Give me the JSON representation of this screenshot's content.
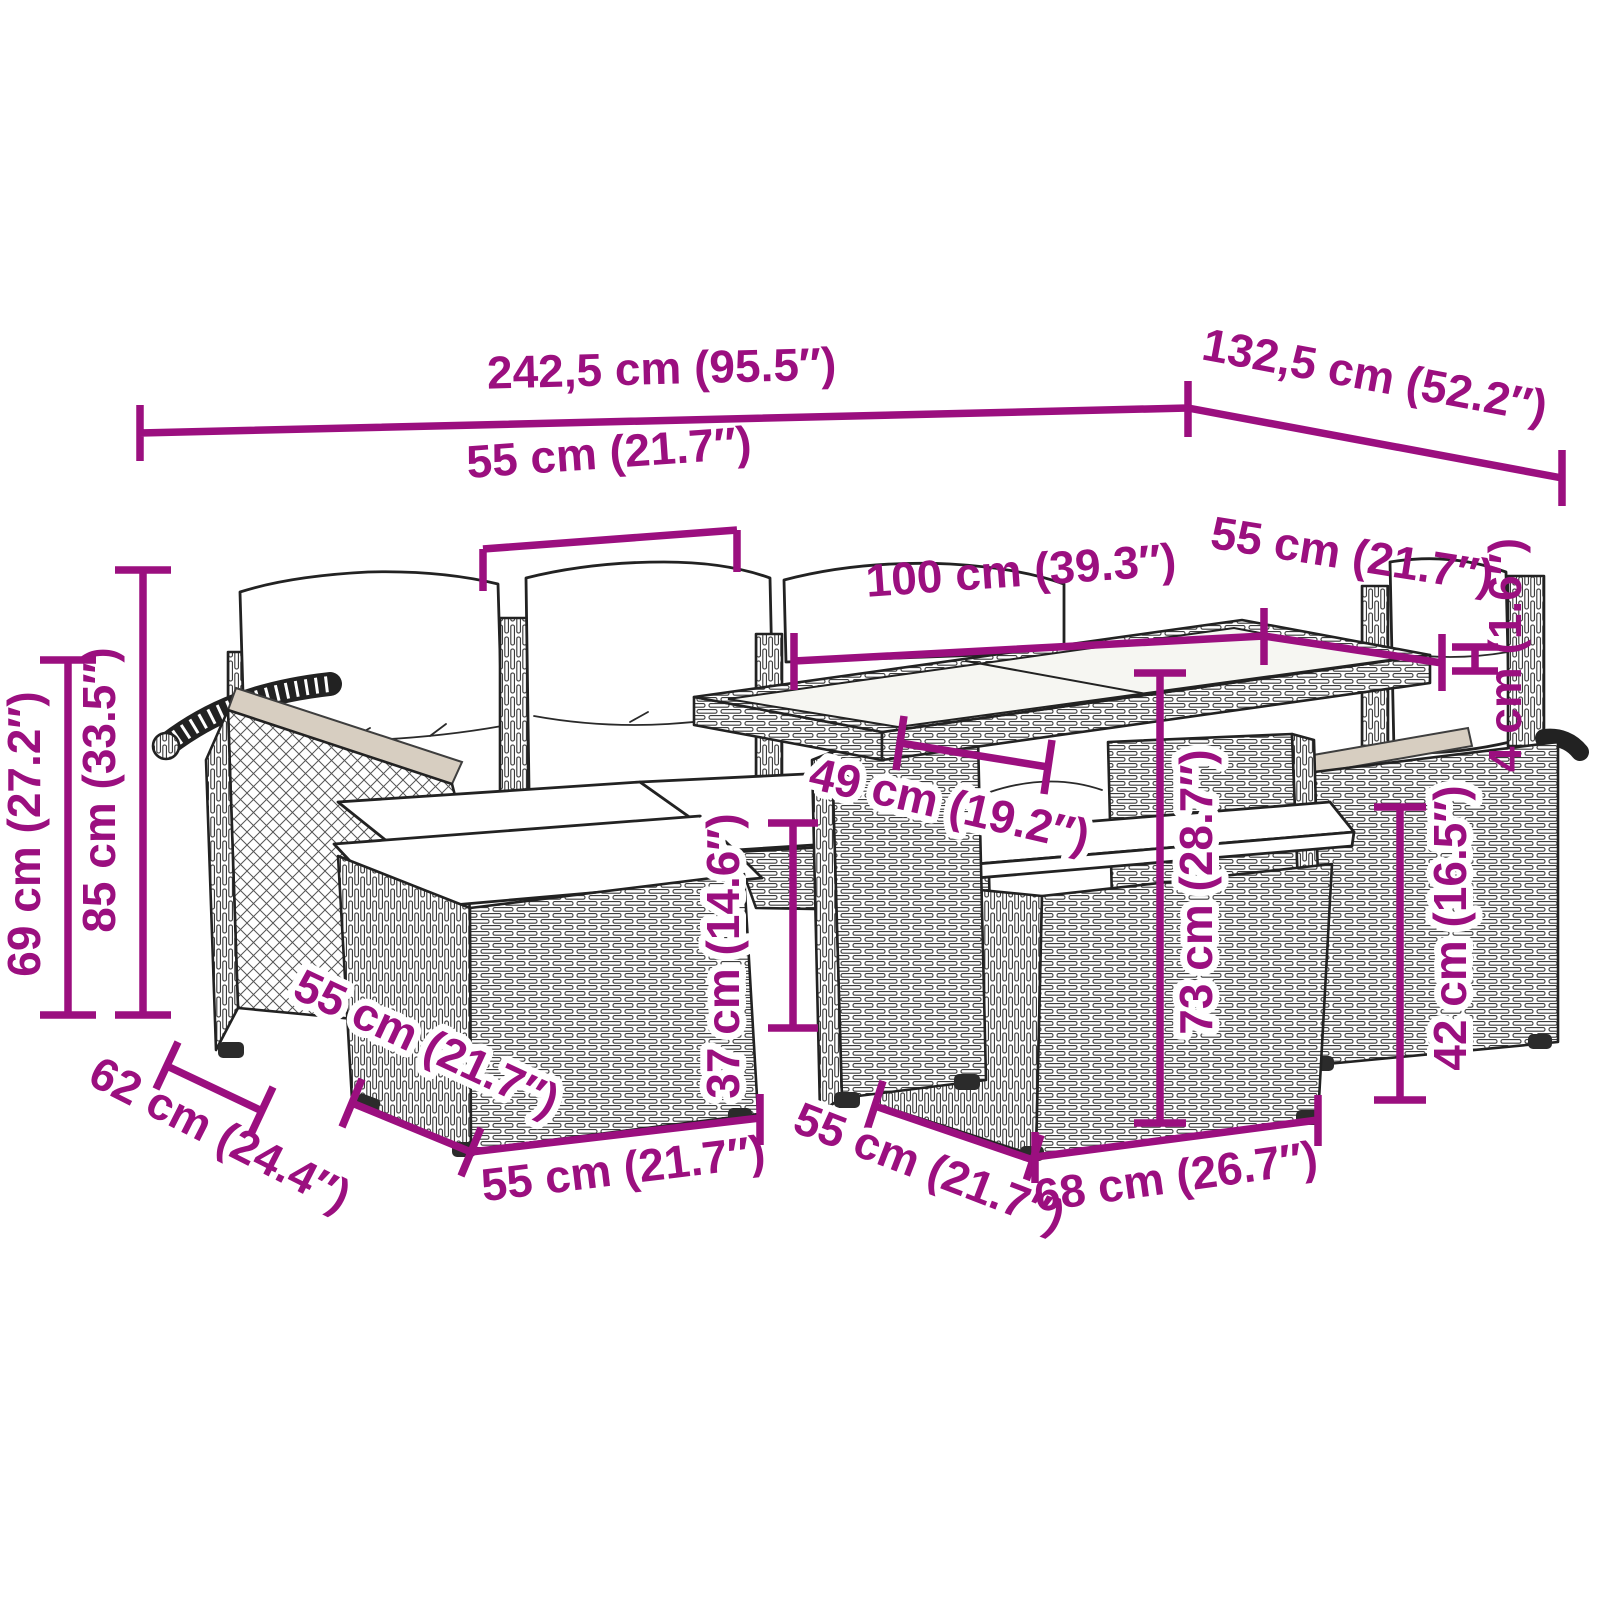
{
  "page": {
    "background": "#ffffff"
  },
  "diagram": {
    "type": "product-dimension-diagram",
    "subject": "poly rattan garden lounge set with cushions, glass-top table and footstools",
    "accent_color": "#9B0F7F",
    "line_color": "#222222",
    "dims": [
      {
        "id": "overall-width",
        "label": "242,5 cm (95.5″)"
      },
      {
        "id": "overall-depth",
        "label": "132,5 cm (52.2″)"
      },
      {
        "id": "seat-width",
        "label": "55 cm (21.7″)"
      },
      {
        "id": "table-length",
        "label": "100 cm (39.3″)"
      },
      {
        "id": "table-depth",
        "label": "55 cm (21.7″)"
      },
      {
        "id": "tabletop-thickness",
        "label": "4 cm (1.6″)"
      },
      {
        "id": "backrest-height",
        "label": "85 cm (33.5″)"
      },
      {
        "id": "armrest-height",
        "label": "69 cm (27.2″)"
      },
      {
        "id": "table-clearance",
        "label": "49 cm (19.2″)"
      },
      {
        "id": "seat-height",
        "label": "37 cm (14.6″)"
      },
      {
        "id": "table-height",
        "label": "73 cm (28.7″)"
      },
      {
        "id": "stool-height",
        "label": "42 cm (16.5″)"
      },
      {
        "id": "sofa-depth",
        "label": "62 cm (24.4″)"
      },
      {
        "id": "footstool-depth",
        "label": "55 cm (21.7″)"
      },
      {
        "id": "footstool-width",
        "label": "55 cm (21.7″)"
      },
      {
        "id": "base-depth",
        "label": "55 cm (21.7″)"
      },
      {
        "id": "base-width",
        "label": "68 cm (26.7″)"
      }
    ]
  }
}
